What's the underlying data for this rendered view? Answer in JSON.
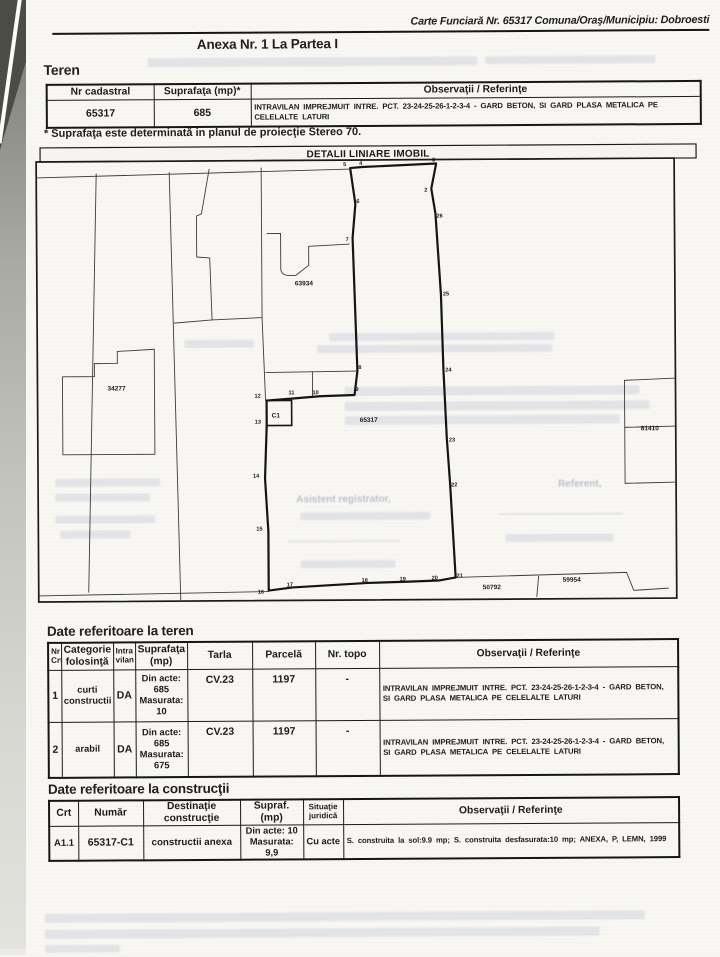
{
  "page_header": {
    "carte": "Carte Funciară Nr. 65317 Comuna/Oraş/Municipiu: Dobroesti",
    "anexa": "Anexa Nr. 1 La Partea I"
  },
  "teren_section": {
    "heading": "Teren",
    "headers": [
      "Nr cadastral",
      "Suprafaţa (mp)*",
      "Observaţii / Referinţe"
    ],
    "row": {
      "nr_cadastral": "65317",
      "suprafata": "685",
      "observatii": "INTRAVILAN IMPREJMUIT INTRE. PCT. 23-24-25-26-1-2-3-4 - GARD BETON, SI GARD PLASA METALICA PE CELELALTE LATURI"
    },
    "note": "* Suprafaţa este determinată in planul de proiecţie Stereo 70."
  },
  "map": {
    "title": "DETALII LINIARE IMOBIL",
    "parcel_labels": [
      {
        "text": "63934",
        "x": 296,
        "y": 285,
        "size": 6
      },
      {
        "text": "34277",
        "x": 108,
        "y": 389,
        "size": 7
      },
      {
        "text": "65317",
        "x": 360,
        "y": 422,
        "size": 8
      },
      {
        "text": "C1",
        "x": 272,
        "y": 417,
        "size": 7
      },
      {
        "text": "81410",
        "x": 641,
        "y": 432,
        "size": 5
      },
      {
        "text": "50792",
        "x": 482,
        "y": 590,
        "size": 6.5
      },
      {
        "text": "59954",
        "x": 562,
        "y": 583,
        "size": 6.5
      }
    ],
    "point_labels": [
      {
        "text": "5",
        "x": 345,
        "y": 166
      },
      {
        "text": "4",
        "x": 361,
        "y": 165
      },
      {
        "text": "3",
        "x": 434,
        "y": 162
      },
      {
        "text": "2",
        "x": 426,
        "y": 192
      },
      {
        "text": "26",
        "x": 438,
        "y": 218
      },
      {
        "text": "25",
        "x": 444,
        "y": 296
      },
      {
        "text": "24",
        "x": 446,
        "y": 372
      },
      {
        "text": "23",
        "x": 449,
        "y": 442
      },
      {
        "text": "22",
        "x": 451,
        "y": 487
      },
      {
        "text": "21",
        "x": 456,
        "y": 578
      },
      {
        "text": "20",
        "x": 431,
        "y": 580
      },
      {
        "text": "19",
        "x": 399,
        "y": 581
      },
      {
        "text": "18",
        "x": 361,
        "y": 582
      },
      {
        "text": "17",
        "x": 286,
        "y": 586
      },
      {
        "text": "16",
        "x": 257,
        "y": 593
      },
      {
        "text": "15",
        "x": 256,
        "y": 530
      },
      {
        "text": "14",
        "x": 253,
        "y": 477
      },
      {
        "text": "13",
        "x": 255,
        "y": 423
      },
      {
        "text": "12",
        "x": 255,
        "y": 397
      },
      {
        "text": "11",
        "x": 289,
        "y": 394
      },
      {
        "text": "10",
        "x": 313,
        "y": 394
      },
      {
        "text": "9",
        "x": 356,
        "y": 391
      },
      {
        "text": "8",
        "x": 359,
        "y": 369
      },
      {
        "text": "7",
        "x": 347,
        "y": 241
      },
      {
        "text": "6",
        "x": 358,
        "y": 203
      }
    ],
    "bleed_texts": [
      {
        "text": "Asistent registrator,",
        "x": 296,
        "y": 494,
        "size": 10
      },
      {
        "text": "Referent,",
        "x": 558,
        "y": 480,
        "size": 10
      }
    ]
  },
  "teren_details": {
    "heading": "Date referitoare la teren",
    "headers": [
      "Nr\nCrt",
      "Categorie\nfolosinţă",
      "Intra\nvilan",
      "Suprafaţa\n(mp)",
      "Tarla",
      "Parcelă",
      "Nr. topo",
      "Observaţii / Referinţe"
    ],
    "rows": [
      [
        "1",
        "curti\nconstructii",
        "DA",
        "Din acte:\n685\nMasurata:\n10",
        "CV.23",
        "1197",
        "-",
        "INTRAVILAN IMPREJMUIT INTRE. PCT. 23-24-25-26-1-2-3-4 - GARD BETON, SI GARD PLASA METALICA PE CELELALTE LATURI"
      ],
      [
        "2",
        "arabil",
        "DA",
        "Din acte:\n685\nMasurata:\n675",
        "CV.23",
        "1197",
        "-",
        "INTRAVILAN IMPREJMUIT INTRE. PCT. 23-24-25-26-1-2-3-4 - GARD BETON, SI GARD PLASA METALICA PE CELELALTE LATURI"
      ]
    ]
  },
  "constructii_details": {
    "heading": "Date referitoare la construcţii",
    "headers": [
      "Crt",
      "Număr",
      "Destinaţie\nconstrucţie",
      "Supraf. (mp)",
      "Situaţie\njuridică",
      "Observaţii / Referinţe"
    ],
    "rows": [
      [
        "A1.1",
        "65317-C1",
        "constructii anexa",
        "Din acte: 10\nMasurata: 9,9",
        "Cu acte",
        "S. construita la sol:9.9 mp; S. construita desfasurata:10 mp;   ANEXA, P, LEMN, 1999"
      ]
    ]
  }
}
